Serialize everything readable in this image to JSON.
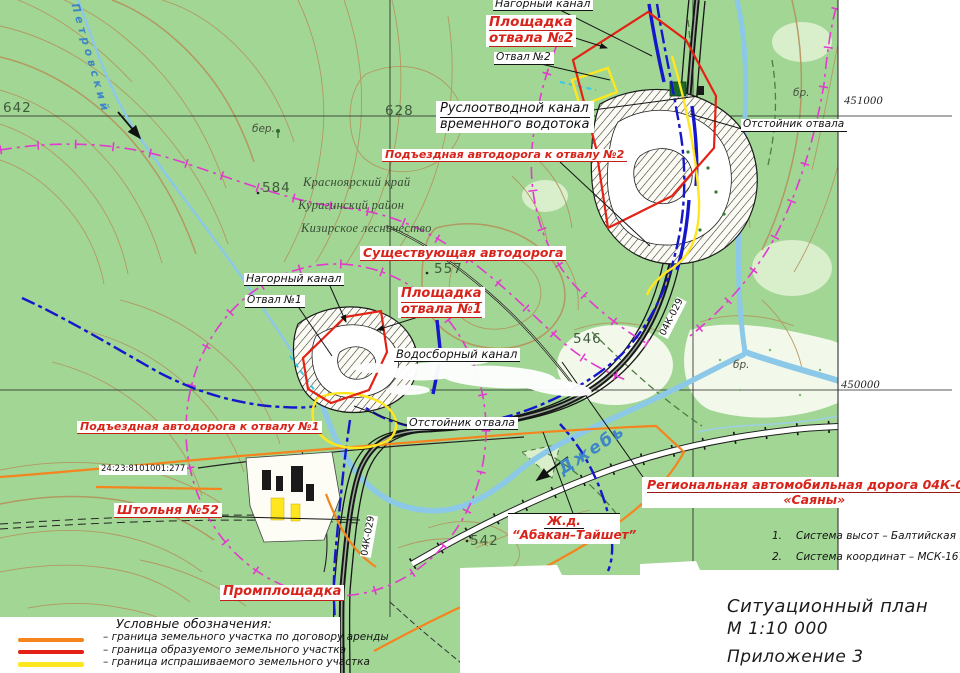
{
  "map": {
    "site_labels": {
      "nagorny_kanal_top": "Нагорный канал",
      "ploshchadka_otvala_2_l1": "Площадка",
      "ploshchadka_otvala_2_l2": "отвала №2",
      "otval_2": "Отвал №2",
      "ruslootvodnoy_l1": "Руслоотводной канал",
      "ruslootvodnoy_l2": "временного водотока",
      "podezdnaya_otval_2": "Подъездная автодорога к отвалу №2",
      "otstoynik_otvala_top": "Отстойник отвала",
      "sushchestvuyushchaya_avtodoroga": "Существующая автодорога",
      "nagorny_kanal_left": "Нагорный канал",
      "otval_1": "Отвал №1",
      "ploshchadka_otvala_1_l1": "Площадка",
      "ploshchadka_otvala_1_l2": "отвала №1",
      "vodosborny_kanal": "Водосборный канал",
      "otstoynik_otvala_mid": "Отстойник отвала",
      "podezdnaya_otval_1": "Подъездная автодорога к отвалу №1",
      "shtolnya": "Штольня №52",
      "promploshchadka": "Промплощадка",
      "regionalnaya_l1": "Региональная автомобильная дорога 04К-029",
      "regionalnaya_l2": "«Саяны»",
      "zhd_l1": "Ж.д.",
      "zhd_l2": "“Абакан–Тайшет”",
      "cadastral_number": "24:23:8101001:277"
    },
    "admin_labels": {
      "krai": "Красноярский край",
      "raion": "Курагинский район",
      "lesnichestvo": "Кизирское лесничество"
    },
    "water_labels": {
      "dzheb": "Джебь",
      "petrovskiy": "Петровский"
    },
    "road_labels": {
      "r04k_top": "04К-029",
      "r04k_bottom": "04К-029"
    },
    "elevations": {
      "e642": "642",
      "e628": "628",
      "e584": "584",
      "e557": "557",
      "e546": "546",
      "e542": "542"
    },
    "terrain_marks": {
      "ber": "бер.",
      "br_top": "бр.",
      "br_mid": "бр."
    },
    "grid": {
      "northing_451000": "451000",
      "northing_450000": "450000"
    }
  },
  "notes": {
    "items": [
      {
        "num": "1.",
        "text": "Система высот – Балтийская 1977 г."
      },
      {
        "num": "2.",
        "text": "Система координат – МСК-167."
      }
    ]
  },
  "title_block": {
    "title": "Ситуационный план",
    "scale": "М 1:10 000",
    "appendix": "Приложение 3"
  },
  "legend": {
    "title": "Условные обозначения:",
    "items": [
      {
        "color": "#f5841e",
        "text": "– граница земельного участка по договору аренды"
      },
      {
        "color": "#e42114",
        "text": "– граница образуемого земельного участка"
      },
      {
        "color": "#ffe61e",
        "text": "– граница испрашиваемого земельного участка"
      }
    ]
  },
  "colors": {
    "map_green": "#a1d694",
    "contour_brown": "#b5925c",
    "water_blue": "#8cc8e8",
    "channel_blue": "#1616cc",
    "boundary_magenta": "#e23ace",
    "boundary_lease_orange": "#f5841e",
    "boundary_formed_red": "#e42114",
    "boundary_requested_yellow": "#ffe61e"
  }
}
